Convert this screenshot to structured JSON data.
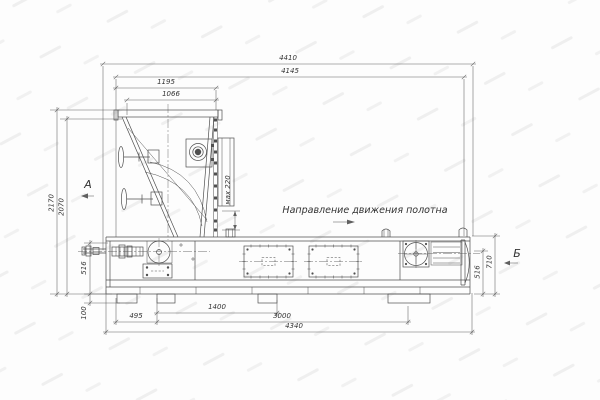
{
  "page": {
    "background": "#fcfcfc"
  },
  "drawing": {
    "direction_note": "Направление движения полотна",
    "view_a_label": "А",
    "view_b_label": "Б",
    "max_gap_note": "мах 220",
    "dims_top": {
      "overall": "4410",
      "upper": "4145",
      "hopper_outer": "1195",
      "hopper_inner": "1066"
    },
    "dims_left": {
      "overall_height": "2170",
      "hopper_height": "2070",
      "body_height": "516",
      "foot_height": "100"
    },
    "dims_right": {
      "frame_height": "516",
      "end_height": "710"
    },
    "dims_bottom": {
      "offset": "495",
      "span_mid": "1400",
      "span_main": "3000",
      "base_overall": "4340"
    },
    "colors": {
      "line": "#4f4f4f",
      "dim_line": "#606060",
      "text": "#333333",
      "watermark": "#ededed",
      "background": "#fcfcfc"
    }
  }
}
